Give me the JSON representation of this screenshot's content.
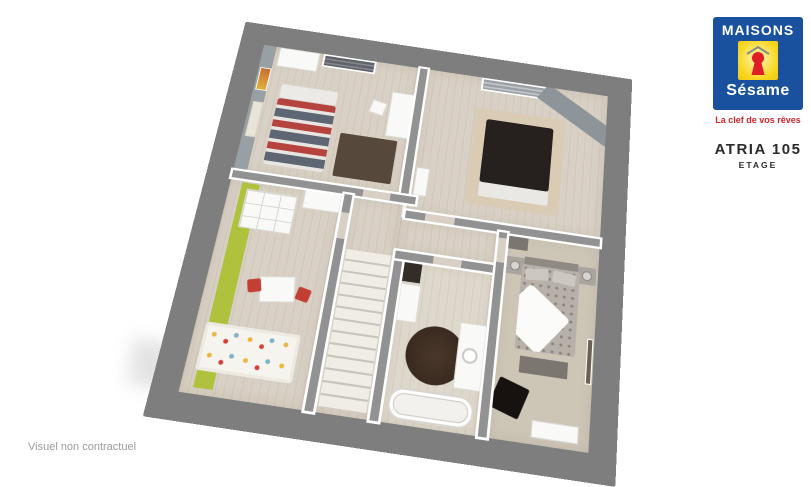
{
  "brand": {
    "name_top": "MAISONS",
    "name_bottom": "Sésame",
    "tagline": "La clef de vos rêves",
    "colors": {
      "blue": "#1a519f",
      "yellow": "#f7d51d",
      "red": "#e01e25"
    }
  },
  "plan": {
    "title": "ATRIA 105",
    "level": "ETAGE"
  },
  "footer": {
    "disclaimer": "Visuel non contractuel"
  },
  "floorplan": {
    "outer_wall_color": "#7e7e7e",
    "floor_color": "#d8d0c4",
    "carpet_color": "#cdc6b7",
    "accent_green": "#aec23e",
    "accent_gray_wall": "#98a0a4"
  }
}
